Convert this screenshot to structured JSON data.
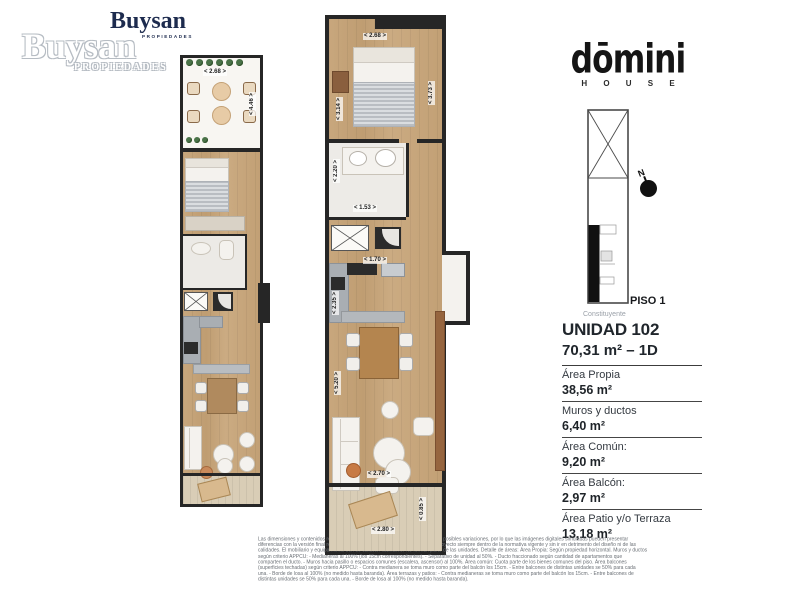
{
  "colors": {
    "brand_navy": "#1d2b4e",
    "wall": "#262626",
    "wood": "#c6a379",
    "deck": "#d9cdb6",
    "counter": "#a9aeb3",
    "plant_green": "#4a7348",
    "text_dark": "#20262c",
    "muted_gray": "#9aa0a8"
  },
  "brand": {
    "logo_text": "Buysan",
    "logo_subtext": "PROPIEDADES",
    "watermark_text": "Buysan",
    "watermark_subtext": "PROPIEDADES"
  },
  "project": {
    "logo_text": "dōmini",
    "logo_subtext": "H O U S E",
    "floor_label": "PISO 1",
    "street_label": "Constituyente",
    "compass_label": "N"
  },
  "unit": {
    "title": "UNIDAD 102",
    "subtitle": "70,31 m² – 1D",
    "areas": [
      {
        "label": "Área Propia",
        "value": "38,56 m²"
      },
      {
        "label": "Muros y ductos",
        "value": "6,40 m²"
      },
      {
        "label": "Área Común:",
        "value": "9,20 m²"
      },
      {
        "label": "Área Balcón:",
        "value": "2,97 m²"
      },
      {
        "label": "Área Patio y/o Terraza",
        "value": "13,18 m²"
      }
    ]
  },
  "plan_small": {
    "dim_top": "< 2.68 >",
    "dim_right": "< 4.46 >"
  },
  "plan_large": {
    "dim_top": "< 2.68 >",
    "dim_bed_left": "< 3.14 >",
    "dim_bed_right": "< 3.73 >",
    "dim_bath_left": "< 2.20 >",
    "dim_bath_bottom": "< 1.53 >",
    "dim_kitchen_top": "< 1.70 >",
    "dim_kitchen_left": "< 2.35 >",
    "dim_living_left": "< 5.20 >",
    "dim_living_bottom": "< 2.70 >",
    "dim_balcony_bottom": "< 2.80 >",
    "dim_balcony_right": "< 0.85 >"
  },
  "disclaimer": {
    "lines": [
      "Las dimensiones y contenidos responden a un permiso municipal y están sujetas a posibles variaciones, por lo que las imágenes digitales simuladas pueden presentar",
      "diferencias con la versión final real. La empresa podrá realizar modificaciones al proyecto siempre dentro de la normativa vigente y sin ir en detrimento del diseño ni de las",
      "calidades. El mobiliario y equipamiento son de carácter ilustrativo. No forman parte de las unidades. Detalle de áreas: Área Propia: Según propiedad horizontal. Muros y ductos",
      "según criterio APPCU: - Medianeras al 100% (los 15cm correspondientes). - Separativo de unidad al 50%. - Ducto fraccionado según cantidad de apartamentos que",
      "comparten el ducto. - Muros hacia pasillo o espacios comunes (escalera, ascensor) al 100%. Área común: Cuota parte de los bienes comunes del piso. Área balcones",
      "(superficies techadas) según criterio APPCU: - Contra medianera se toma muro como parte del balcón los 15cm. - Entre balcones de distintas unidades se 50% para cada",
      "una. - Borde de losa al 100% (no medido hasta baranda). Área terrazas y patios: - Contra medianeras se toma muro como parte del balcón los 15cm. - Entre balcones de",
      "distintas unidades se 50% para cada una. - Borde de losa al 100% (no medido hasta baranda)."
    ]
  }
}
